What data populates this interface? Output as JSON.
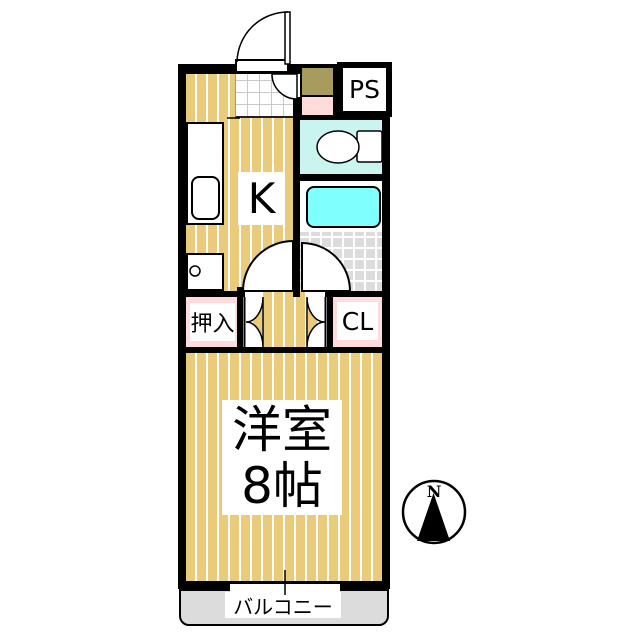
{
  "plan": {
    "labels": {
      "kitchen": "K",
      "pipe_space": "PS",
      "oshiire": "押入",
      "closet": "CL",
      "room_name": "洋室",
      "room_size": "8帖",
      "balcony": "バルコニー",
      "compass_north": "N"
    },
    "icons": {
      "compass": "north-arrow-compass",
      "toilet": "toilet-plan-symbol",
      "doors": "swing-door-arcs",
      "sink": "kitchen-sink",
      "bathtub": "bathtub"
    },
    "colors": {
      "wall": "#000000",
      "floor": "#EACB79",
      "stripe": "#FFFFFF",
      "closet_pink": "#FFDBDB",
      "toilet_cyan": "#C9F4F0",
      "bathtub_cyan": "#80FFFF",
      "tile_gray": "#DCDCDC",
      "balcony_gray": "#DCDCDC",
      "shoe_cabinet_khaki": "#A89B5E"
    }
  }
}
